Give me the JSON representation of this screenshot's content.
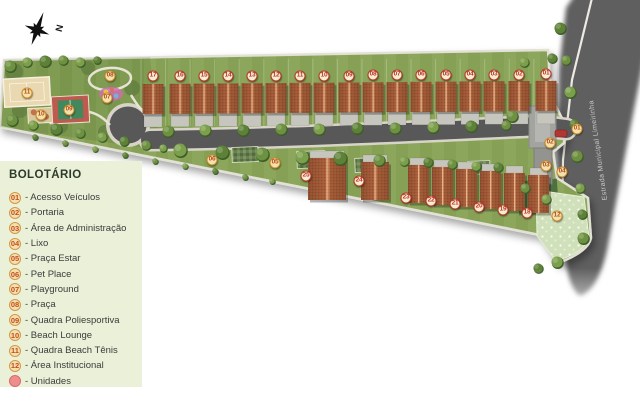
{
  "legend": {
    "title": "BOLOTÁRIO",
    "separator": "-",
    "items": [
      {
        "num": "01",
        "label": "Acesso Veículos"
      },
      {
        "num": "02",
        "label": "Portaria"
      },
      {
        "num": "03",
        "label": "Área de Administração"
      },
      {
        "num": "04",
        "label": "Lixo"
      },
      {
        "num": "05",
        "label": "Praça Estar"
      },
      {
        "num": "06",
        "label": "Pet Place"
      },
      {
        "num": "07",
        "label": "Playground"
      },
      {
        "num": "08",
        "label": "Praça"
      },
      {
        "num": "09",
        "label": "Quadra Poliesportiva"
      },
      {
        "num": "10",
        "label": "Beach Lounge"
      },
      {
        "num": "11",
        "label": "Quadra Beach Tênis"
      },
      {
        "num": "12",
        "label": "Área Institucional"
      }
    ],
    "units_item": {
      "label": "Unidades"
    }
  },
  "map": {
    "compass_label": "N",
    "road_label": "Estrada Municipal Limeirinha",
    "unit_markers": [
      {
        "num": "17",
        "x": 153,
        "y": 76
      },
      {
        "num": "16",
        "x": 180,
        "y": 76
      },
      {
        "num": "15",
        "x": 204,
        "y": 76
      },
      {
        "num": "14",
        "x": 228,
        "y": 76
      },
      {
        "num": "13",
        "x": 252,
        "y": 76
      },
      {
        "num": "12",
        "x": 276,
        "y": 76
      },
      {
        "num": "11",
        "x": 300,
        "y": 76
      },
      {
        "num": "10",
        "x": 324,
        "y": 76
      },
      {
        "num": "09",
        "x": 349,
        "y": 76
      },
      {
        "num": "08",
        "x": 373,
        "y": 75
      },
      {
        "num": "07",
        "x": 397,
        "y": 75
      },
      {
        "num": "06",
        "x": 421,
        "y": 75
      },
      {
        "num": "05",
        "x": 446,
        "y": 75
      },
      {
        "num": "04",
        "x": 470,
        "y": 75
      },
      {
        "num": "03",
        "x": 494,
        "y": 75
      },
      {
        "num": "02",
        "x": 519,
        "y": 75
      },
      {
        "num": "01",
        "x": 546,
        "y": 74
      },
      {
        "num": "25",
        "x": 306,
        "y": 176
      },
      {
        "num": "24",
        "x": 359,
        "y": 181
      },
      {
        "num": "23",
        "x": 406,
        "y": 198
      },
      {
        "num": "22",
        "x": 431,
        "y": 201
      },
      {
        "num": "21",
        "x": 455,
        "y": 204
      },
      {
        "num": "20",
        "x": 479,
        "y": 207
      },
      {
        "num": "19",
        "x": 503,
        "y": 210
      },
      {
        "num": "18",
        "x": 527,
        "y": 213
      }
    ],
    "amenity_markers": [
      {
        "num": "01",
        "x": 577,
        "y": 129
      },
      {
        "num": "02",
        "x": 550,
        "y": 143
      },
      {
        "num": "03",
        "x": 546,
        "y": 166
      },
      {
        "num": "04",
        "x": 562,
        "y": 172
      },
      {
        "num": "05",
        "x": 275,
        "y": 163
      },
      {
        "num": "06",
        "x": 212,
        "y": 160
      },
      {
        "num": "07",
        "x": 107,
        "y": 98
      },
      {
        "num": "08",
        "x": 110,
        "y": 76
      },
      {
        "num": "09",
        "x": 69,
        "y": 110
      },
      {
        "num": "10",
        "x": 41,
        "y": 115
      },
      {
        "num": "11",
        "x": 27,
        "y": 93
      },
      {
        "num": "12",
        "x": 557,
        "y": 216
      }
    ]
  },
  "colors": {
    "legend_bg": "#ebf1d8",
    "lawn": "#86a155",
    "asphalt": "#5c5c5c",
    "roof": "#a85c38",
    "unit_marker": "#b93527",
    "amenity_marker": "#c9892a",
    "units_dot": "#ee8e8c"
  }
}
